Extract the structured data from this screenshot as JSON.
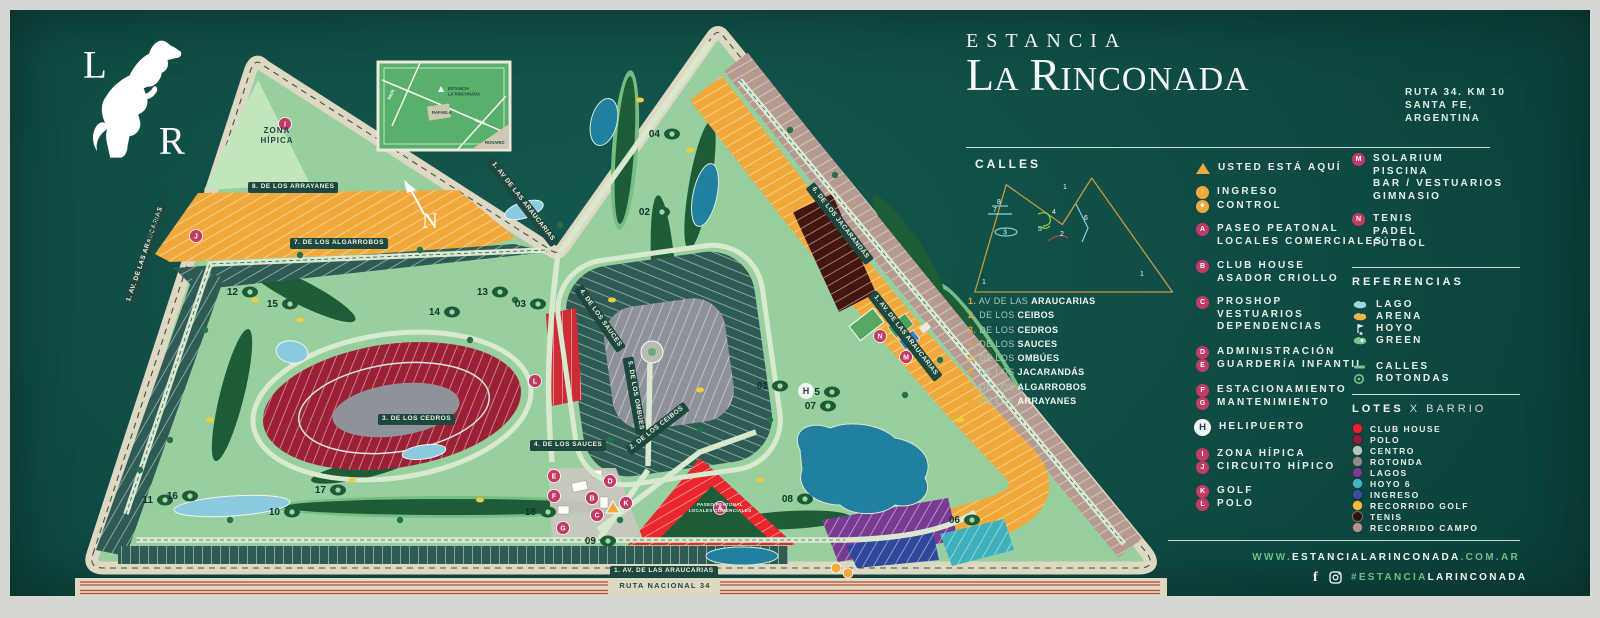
{
  "colors": {
    "poster_bg": "#0f4b44",
    "accent_green": "#6fbd85",
    "marker_pink": "#c23b64",
    "marker_orange": "#f2a93b"
  },
  "logo": {
    "top_letter": "L",
    "bottom_letter": "R"
  },
  "header": {
    "eyebrow": "ESTANCIA",
    "brand_l1": "L",
    "brand_a": "A",
    "brand_r": "R",
    "brand_rest": "INCONADA",
    "addr1": "RUTA 34. KM 10",
    "addr2": "SANTA FE,",
    "addr3": "ARGENTINA"
  },
  "calles": {
    "title": "CALLES",
    "streets": [
      {
        "num": "1.",
        "pre": "AV DE LAS",
        "name": "ARAUCARIAS"
      },
      {
        "num": "2.",
        "pre": "DE LOS",
        "name": "CEIBOS"
      },
      {
        "num": "3.",
        "pre": "DE LOS",
        "name": "CEDROS"
      },
      {
        "num": "4.",
        "pre": "DE LOS",
        "name": "SAUCES"
      },
      {
        "num": "5.",
        "pre": "DE LOS",
        "name": "OMBÚES"
      },
      {
        "num": "6.",
        "pre": "DE LOS",
        "name": "JACARANDÁS"
      },
      {
        "num": "7.",
        "pre": "DE LOS",
        "name": "ALGARROBOS"
      },
      {
        "num": "8.",
        "pre": "DE LOS",
        "name": "ARRAYANES"
      }
    ],
    "diagram": [
      "1",
      "8",
      "7",
      "3",
      "4",
      "5",
      "6",
      "2",
      "1",
      "1"
    ]
  },
  "legend": {
    "usted": "USTED ESTÁ AQUÍ",
    "ingreso": "INGRESO",
    "control": "CONTROL",
    "a": {
      "letter": "A",
      "l1": "PASEO PEATONAL",
      "l2": "LOCALES COMERCIALES"
    },
    "b": {
      "letter": "B",
      "l1": "CLUB HOUSE",
      "l2": "ASADOR CRIOLLO"
    },
    "c": {
      "letter": "C",
      "l1": "PROSHOP",
      "l2": "VESTUARIOS",
      "l3": "DEPENDENCIAS"
    },
    "d": {
      "letter": "D",
      "label": "ADMINISTRACIÓN"
    },
    "e": {
      "letter": "E",
      "label": "GUARDERÍA INFANTIL"
    },
    "f": {
      "letter": "F",
      "label": "ESTACIONAMIENTO"
    },
    "g": {
      "letter": "G",
      "label": "MANTENIMIENTO"
    },
    "h": {
      "letter": "H",
      "label": "HELIPUERTO"
    },
    "i": {
      "letter": "I",
      "label": "ZONA HÍPICA"
    },
    "j": {
      "letter": "J",
      "label": "CIRCUITO HÍPICO"
    },
    "k": {
      "letter": "K",
      "label": "GOLF"
    },
    "l": {
      "letter": "L",
      "label": "POLO"
    },
    "m": {
      "letter": "M",
      "l1": "SOLARIUM",
      "l2": "PISCINA",
      "l3": "BAR / VESTUARIOS",
      "l4": "GIMNASIO"
    },
    "n": {
      "letter": "N",
      "l1": "TENIS",
      "l2": "PADEL",
      "l3": "FÚTBOL"
    }
  },
  "referencias": {
    "title": "REFERENCIAS",
    "lago": "LAGO",
    "arena": "ARENA",
    "hoyo": "HOYO",
    "green": "GREEN",
    "calles": "CALLES",
    "rotondas": "ROTONDAS"
  },
  "lotes": {
    "t1": "LOTES",
    "t2": "X BARRIO",
    "items": [
      {
        "color": "#e8212d",
        "label": "CLUB HOUSE"
      },
      {
        "color": "#8f1f3c",
        "label": "POLO"
      },
      {
        "color": "#b7c8c0",
        "label": "CENTRO"
      },
      {
        "color": "#8d8c89",
        "label": "ROTONDA"
      },
      {
        "color": "#7b3a92",
        "label": "LAGOS"
      },
      {
        "color": "#40b7c0",
        "label": "HOYO 6"
      },
      {
        "color": "#3c4da0",
        "label": "INGRESO"
      },
      {
        "color": "#efb93c",
        "label": "RECORRIDO GOLF"
      },
      {
        "color": "#2e0f0c",
        "label": "TENIS"
      },
      {
        "color": "#b29289",
        "label": "RECORRIDO CAMPO"
      }
    ]
  },
  "footer": {
    "www": "WWW.",
    "domain": "ESTANCIALARINCONADA",
    "tld": ".COM.AR",
    "fb": "f",
    "tag_green": "#ESTANCIA",
    "tag_white": "LARINCONADA"
  },
  "map": {
    "labels": [
      "8. DE LOS ARRAYANES",
      "7. DE LOS ALGARROBOS",
      "1. AV DE LAS ARAUCARIAS",
      "1. AV. DE LAS ARAUCARIAS",
      "1. AV. DE LAS ARAUCARIAS",
      "1. AV. DE LAS ARAUCARIAS",
      "CIRCUITO HÍPICO",
      "2. DE LOS CEIBOS",
      "3. DE LOS CEDROS",
      "4. DE LOS SAUCES",
      "4. DE LOS SAUCES",
      "5. DE LOS OMBÚES",
      "6. DE LOS JACARANDÁS"
    ],
    "zona_line1": "ZONA",
    "zona_line2": "HÍPICA",
    "paseo_line1": "PASEO PEATONAL",
    "paseo_line2": "LOCALES COMERCIALES",
    "ruta": "RUTA NACIONAL 34",
    "north": "N",
    "holes": [
      "01",
      "02",
      "03",
      "04",
      "05",
      "06",
      "07",
      "08",
      "09",
      "10",
      "11",
      "12",
      "13",
      "14",
      "15",
      "16",
      "17",
      "18"
    ],
    "markers": {
      "a": "A",
      "b": "B",
      "c": "C",
      "d": "D",
      "e": "E",
      "f": "F",
      "g": "G",
      "h": "H",
      "i": "I",
      "j": "J",
      "k": "K",
      "l": "L",
      "m": "M",
      "n": "N"
    },
    "inset": {
      "line1": "ESTANCIA",
      "line2": "LA RINCONADA",
      "rafaela": "RAFAELA",
      "rosario": "ROSARIO",
      "rn34": "RN34",
      "rn70": "RN70"
    }
  }
}
